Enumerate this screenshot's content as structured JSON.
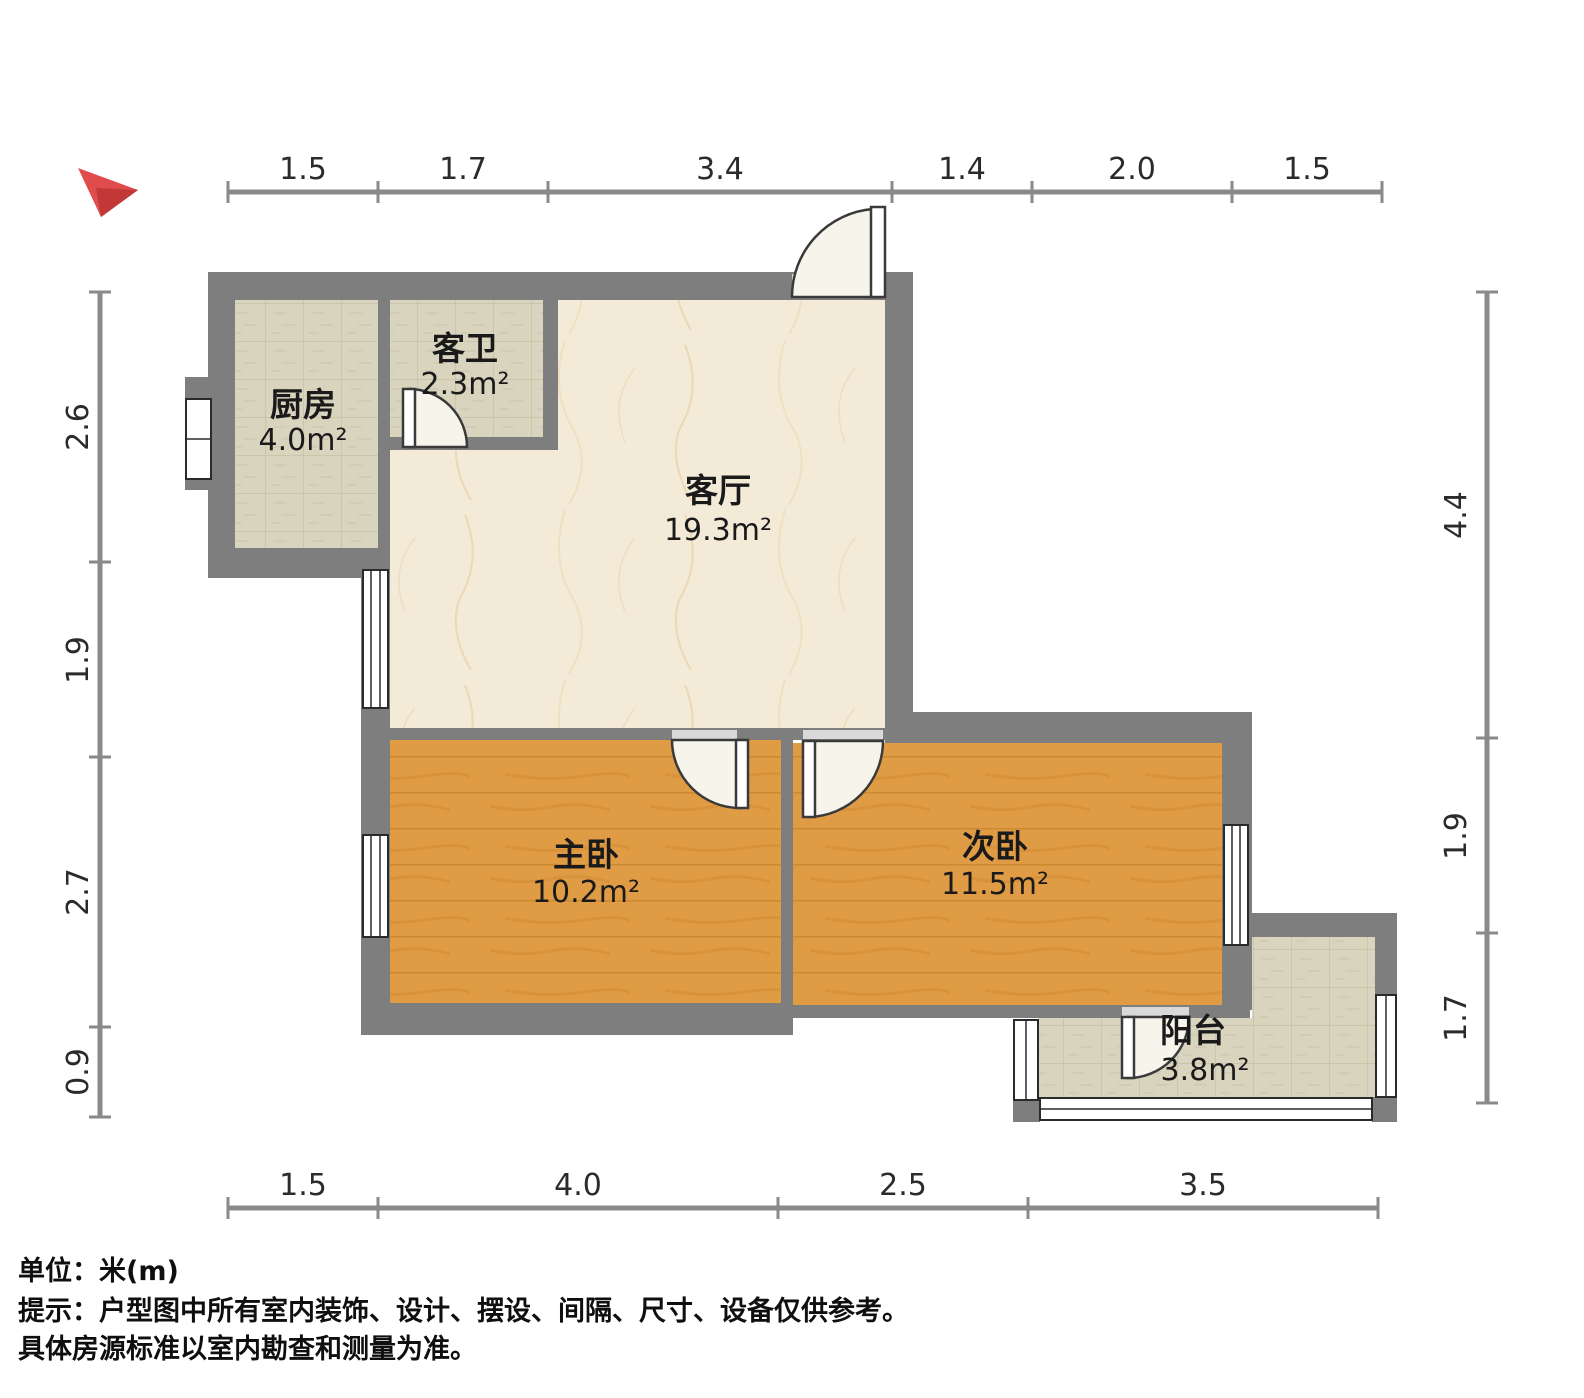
{
  "palette": {
    "wall": "#7e7e7e",
    "door_opening": "#d9d9d9",
    "dim_line": "#8a8a8a",
    "dim_text": "#2b2b2b",
    "tile_floor": "#d9d4be",
    "tile_grid": "#c5c0a6",
    "marble_floor": "#f3ead7",
    "marble_vein": "#e9d0a8",
    "wood_floor": "#e09b45",
    "wood_grain": "#c9882f",
    "compass_red": "#e04b4b",
    "compass_dark": "#c23737"
  },
  "rooms": [
    {
      "name": "厨房",
      "area": "4.0m²"
    },
    {
      "name": "客卫",
      "area": "2.3m²"
    },
    {
      "name": "客厅",
      "area": "19.3m²"
    },
    {
      "name": "主卧",
      "area": "10.2m²"
    },
    {
      "name": "次卧",
      "area": "11.5m²"
    },
    {
      "name": "阳台",
      "area": "3.8m²"
    }
  ],
  "dims": {
    "top": [
      "1.5",
      "1.7",
      "3.4",
      "1.4",
      "2.0",
      "1.5"
    ],
    "bottom": [
      "1.5",
      "4.0",
      "2.5",
      "3.5"
    ],
    "left": [
      "2.6",
      "1.9",
      "2.7",
      "0.9"
    ],
    "right": [
      "4.4",
      "1.9",
      "1.7"
    ]
  },
  "footer": {
    "line1": "单位：米(m)",
    "line2": "提示：户型图中所有室内装饰、设计、摆设、间隔、尺寸、设备仅供参考。",
    "line3": "具体房源标准以室内勘查和测量为准。"
  }
}
